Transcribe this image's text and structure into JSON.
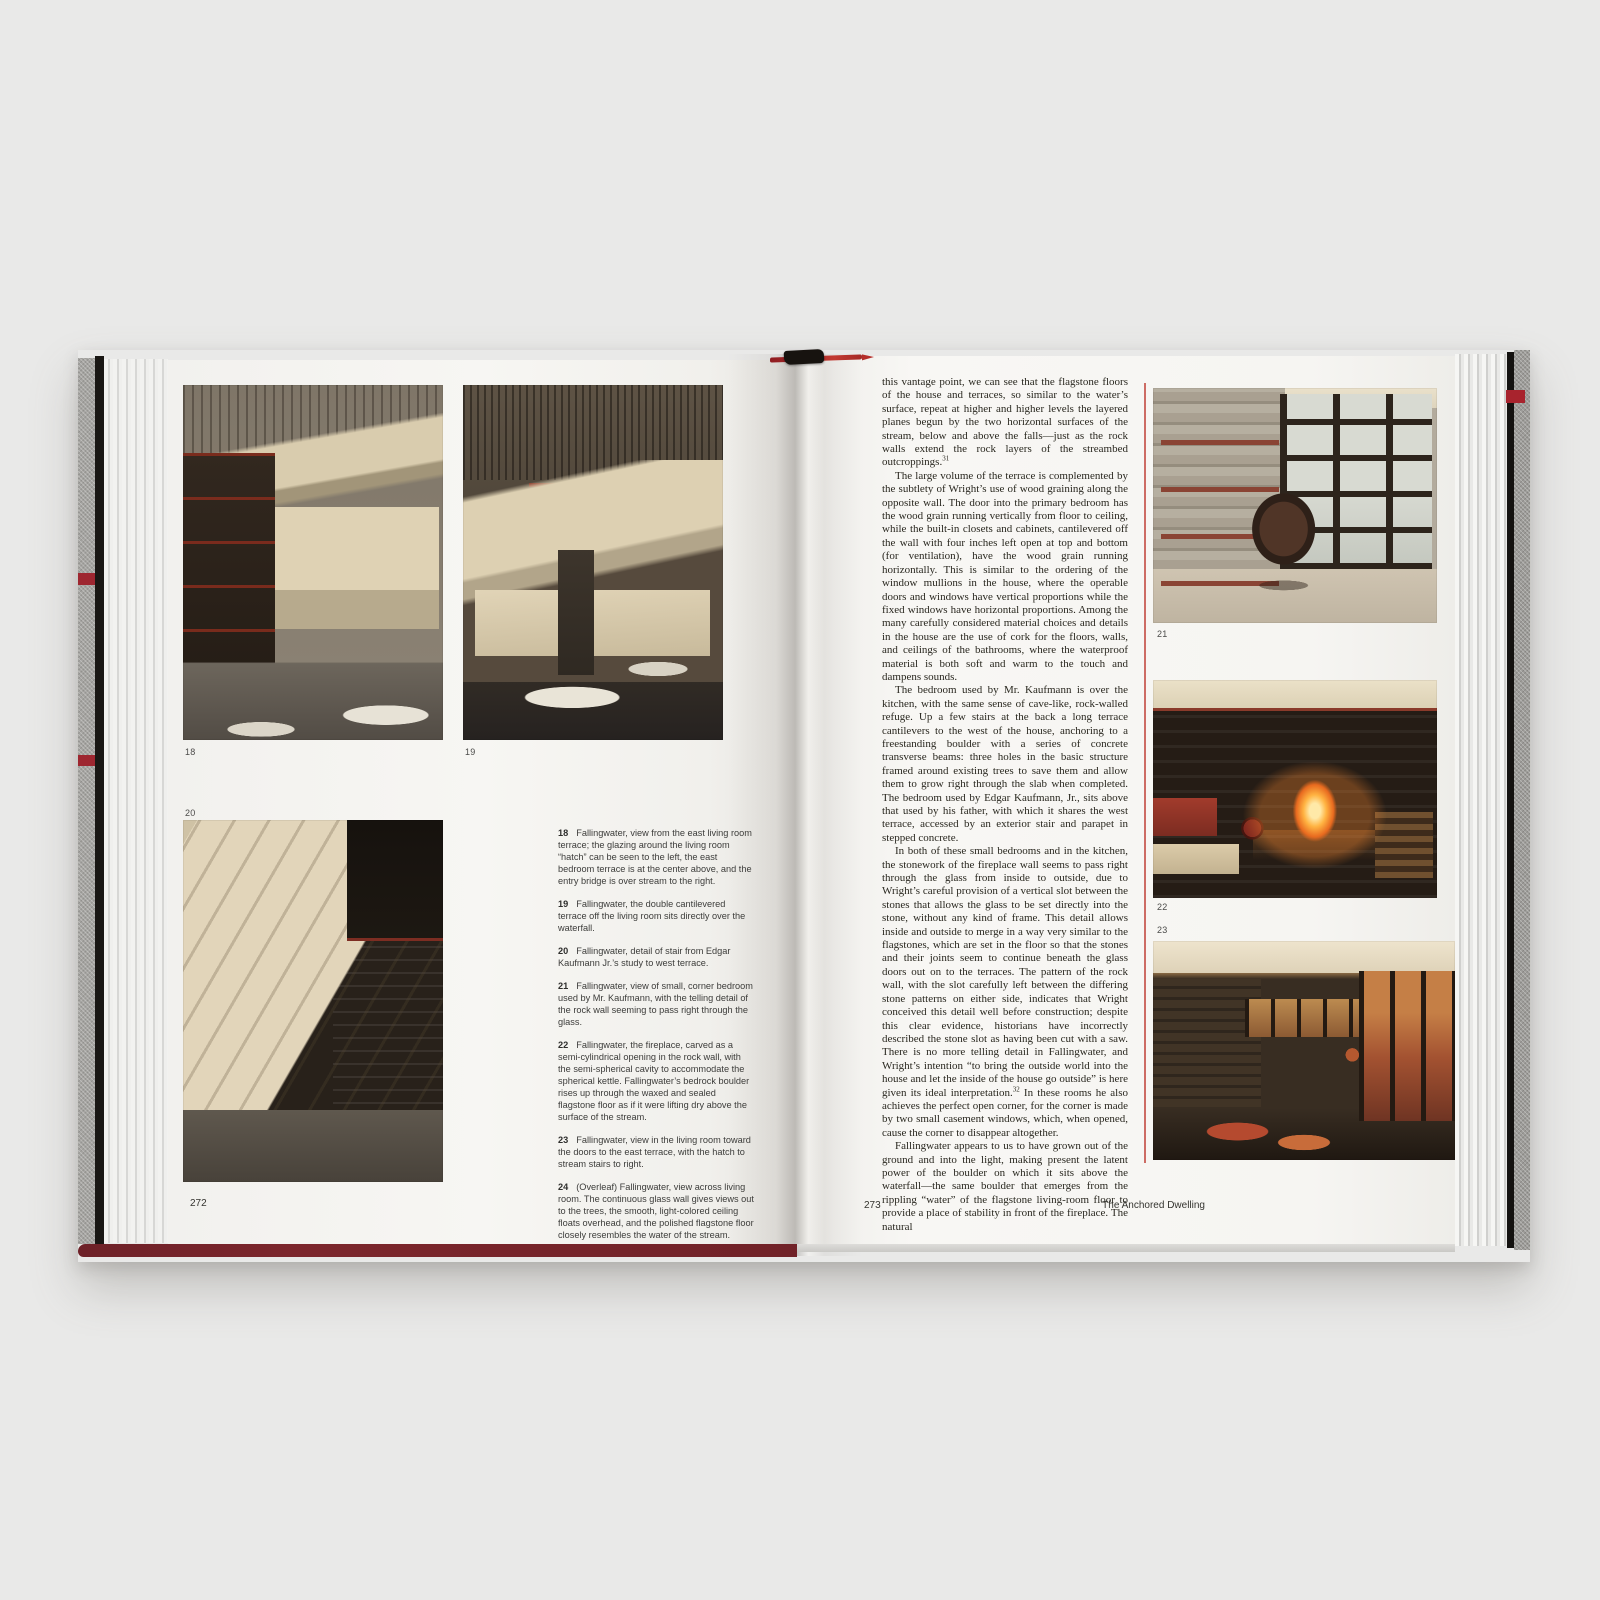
{
  "colors": {
    "accent_red": "#a8232d",
    "cover_maroon": "#6e2128",
    "rule_red": "#c5544a"
  },
  "left_page": {
    "page_number": "272",
    "figure_labels": [
      "18",
      "19",
      "20"
    ],
    "captions": [
      {
        "num": "18",
        "text": "Fallingwater, view from the east living room terrace; the glazing around the living room “hatch” can be seen to the left, the east bedroom terrace is at the center above, and the entry bridge is over stream to the right."
      },
      {
        "num": "19",
        "text": "Fallingwater, the double cantilevered terrace off the living room sits directly over the waterfall."
      },
      {
        "num": "20",
        "text": "Fallingwater, detail of stair from Edgar Kaufmann Jr.’s study to west terrace."
      },
      {
        "num": "21",
        "text": "Fallingwater, view of small, corner bedroom used by Mr. Kaufmann, with the telling detail of the rock wall seeming to pass right through the glass."
      },
      {
        "num": "22",
        "text": "Fallingwater, the fireplace, carved as a semi-cylindrical opening in the rock wall, with the semi-spherical cavity to accommodate the spherical kettle. Fallingwater’s bedrock boulder rises up through the waxed and sealed flagstone floor as if it were lifting dry above the surface of the stream."
      },
      {
        "num": "23",
        "text": "Fallingwater, view in the living room toward the doors to the east terrace, with the hatch to stream stairs to right."
      },
      {
        "num": "24",
        "text": "(Overleaf) Fallingwater, view across living room. The continuous glass wall gives views out to the trees, the smooth, light-colored ceiling floats overhead, and the polished flagstone floor closely resembles the water of the stream."
      }
    ]
  },
  "right_page": {
    "page_number": "273",
    "running_title": "The Anchored Dwelling",
    "figure_labels": [
      "21",
      "22",
      "23"
    ],
    "body": [
      {
        "text": "this vantage point, we can see that the flagstone floors of the house and terraces, so similar to the water’s surface, repeat at higher and higher levels the layered planes begun by the two horizontal surfaces of the stream, below and above the falls—just as the rock walls extend the rock layers of the streambed outcroppings.",
        "sup": "31"
      },
      {
        "text": "The large volume of the terrace is complemented by the subtlety of Wright’s use of wood graining along the opposite wall. The door into the primary bedroom has the wood grain running vertically from floor to ceiling, while the built-in closets and cabinets, cantilevered off the wall with four inches left open at top and bottom (for ventilation), have the wood grain running horizontally. This is similar to the ordering of the window mullions in the house, where the operable doors and windows have vertical proportions while the fixed windows have horizontal proportions. Among the many carefully considered material choices and details in the house are the use of cork for the floors, walls, and ceilings of the bathrooms, where the waterproof material is both soft and warm to the touch and dampens sounds."
      },
      {
        "text": "The bedroom used by Mr. Kaufmann is over the kitchen, with the same sense of cave-like, rock-walled refuge. Up a few stairs at the back a long terrace cantilevers to the west of the house, anchoring to a freestanding boulder with a series of concrete transverse beams: three holes in the basic structure framed around existing trees to save them and allow them to grow right through the slab when completed. The bedroom used by Edgar Kaufmann, Jr., sits above that used by his father, with which it shares the west terrace, accessed by an exterior stair and parapet in stepped concrete."
      },
      {
        "text": "In both of these small bedrooms and in the kitchen, the stonework of the fireplace wall seems to pass right through the glass from inside to outside, due to Wright’s careful provision of a vertical slot between the stones that allows the glass to be set directly into the stone, without any kind of frame. This detail allows inside and outside to merge in a way very similar to the flagstones, which are set in the floor so that the stones and their joints seem to continue beneath the glass doors out on to the terraces. The pattern of the rock wall, with the slot carefully left between the differing stone patterns on either side, indicates that Wright conceived this detail well before construction; despite this clear evidence, historians have incorrectly described the stone slot as having been cut with a saw. There is no more telling detail in Fallingwater, and Wright’s intention “to bring the outside world into the house and let the inside of the house go outside” is here given its ideal interpretation.",
        "sup": "32",
        "text_b": " In these rooms he also achieves the perfect open corner, for the corner is made by two small casement windows, which, when opened, cause the corner to disappear altogether."
      },
      {
        "text": "Fallingwater appears to us to have grown out of the ground and into the light, making present the latent power of the boulder on which it sits above the waterfall—the same boulder that emerges from the rippling “water” of the flagstone living-room floor to provide a place of stability in front of the fireplace. The natural"
      }
    ]
  }
}
